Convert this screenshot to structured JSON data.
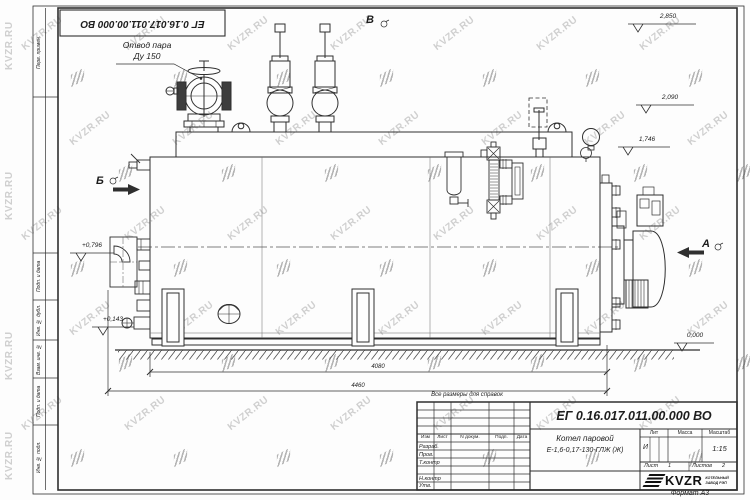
{
  "doc": {
    "number": "ЕГ 0.16.017.011.00.000 ВО",
    "format_label": "Формат А3",
    "reference_note": "Все размеры для справок"
  },
  "annotations": {
    "steam_outlet_line1": "Отвод пара",
    "steam_outlet_line2": "Ду 150"
  },
  "views": {
    "left": "Б",
    "top": "В",
    "right": "А"
  },
  "elevations": [
    {
      "value": "2,850"
    },
    {
      "value": "2,090"
    },
    {
      "value": "1,746"
    },
    {
      "value": "+0,796"
    },
    {
      "value": "+0,143"
    },
    {
      "value": "0,000"
    }
  ],
  "dimensions": {
    "inner": "4080",
    "overall": "4460"
  },
  "margin_fields": [
    "Перв. примен.",
    "Подп. и дата",
    "Инв. № дубл.",
    "Взам. инв. №",
    "Подп. и дата",
    "Инв. № подл."
  ],
  "title_block": {
    "doc_number": "ЕГ 0.16.017.011.00.000 ВО",
    "title_line1": "Котел паровой",
    "title_line2": "Е-1,6-0,17-130-ГЛЖ (Ж)",
    "header_cols": [
      "Изм",
      "Лист",
      "N докум.",
      "Подп.",
      "Дата"
    ],
    "rows": [
      "Разраб.",
      "Пров.",
      "Т.контр",
      "",
      "Н.контр",
      "Утв."
    ],
    "lit_label": "Лит",
    "mass_label": "Масса",
    "scale_label": "Масштаб",
    "lit_value": "И",
    "scale_value": "1:15",
    "sheet_label": "Лист",
    "sheet_value": "1",
    "sheets_label": "Листов",
    "sheets_value": "2",
    "logo_text": "KVZR",
    "logo_sub1": "КОТЕЛЬНЫЙ",
    "logo_sub2": "ЗАВОД РЭП"
  },
  "watermark": {
    "text": "KVZR.RU",
    "color": "#c7c7c7",
    "icon_color": "#b4b4b4"
  }
}
